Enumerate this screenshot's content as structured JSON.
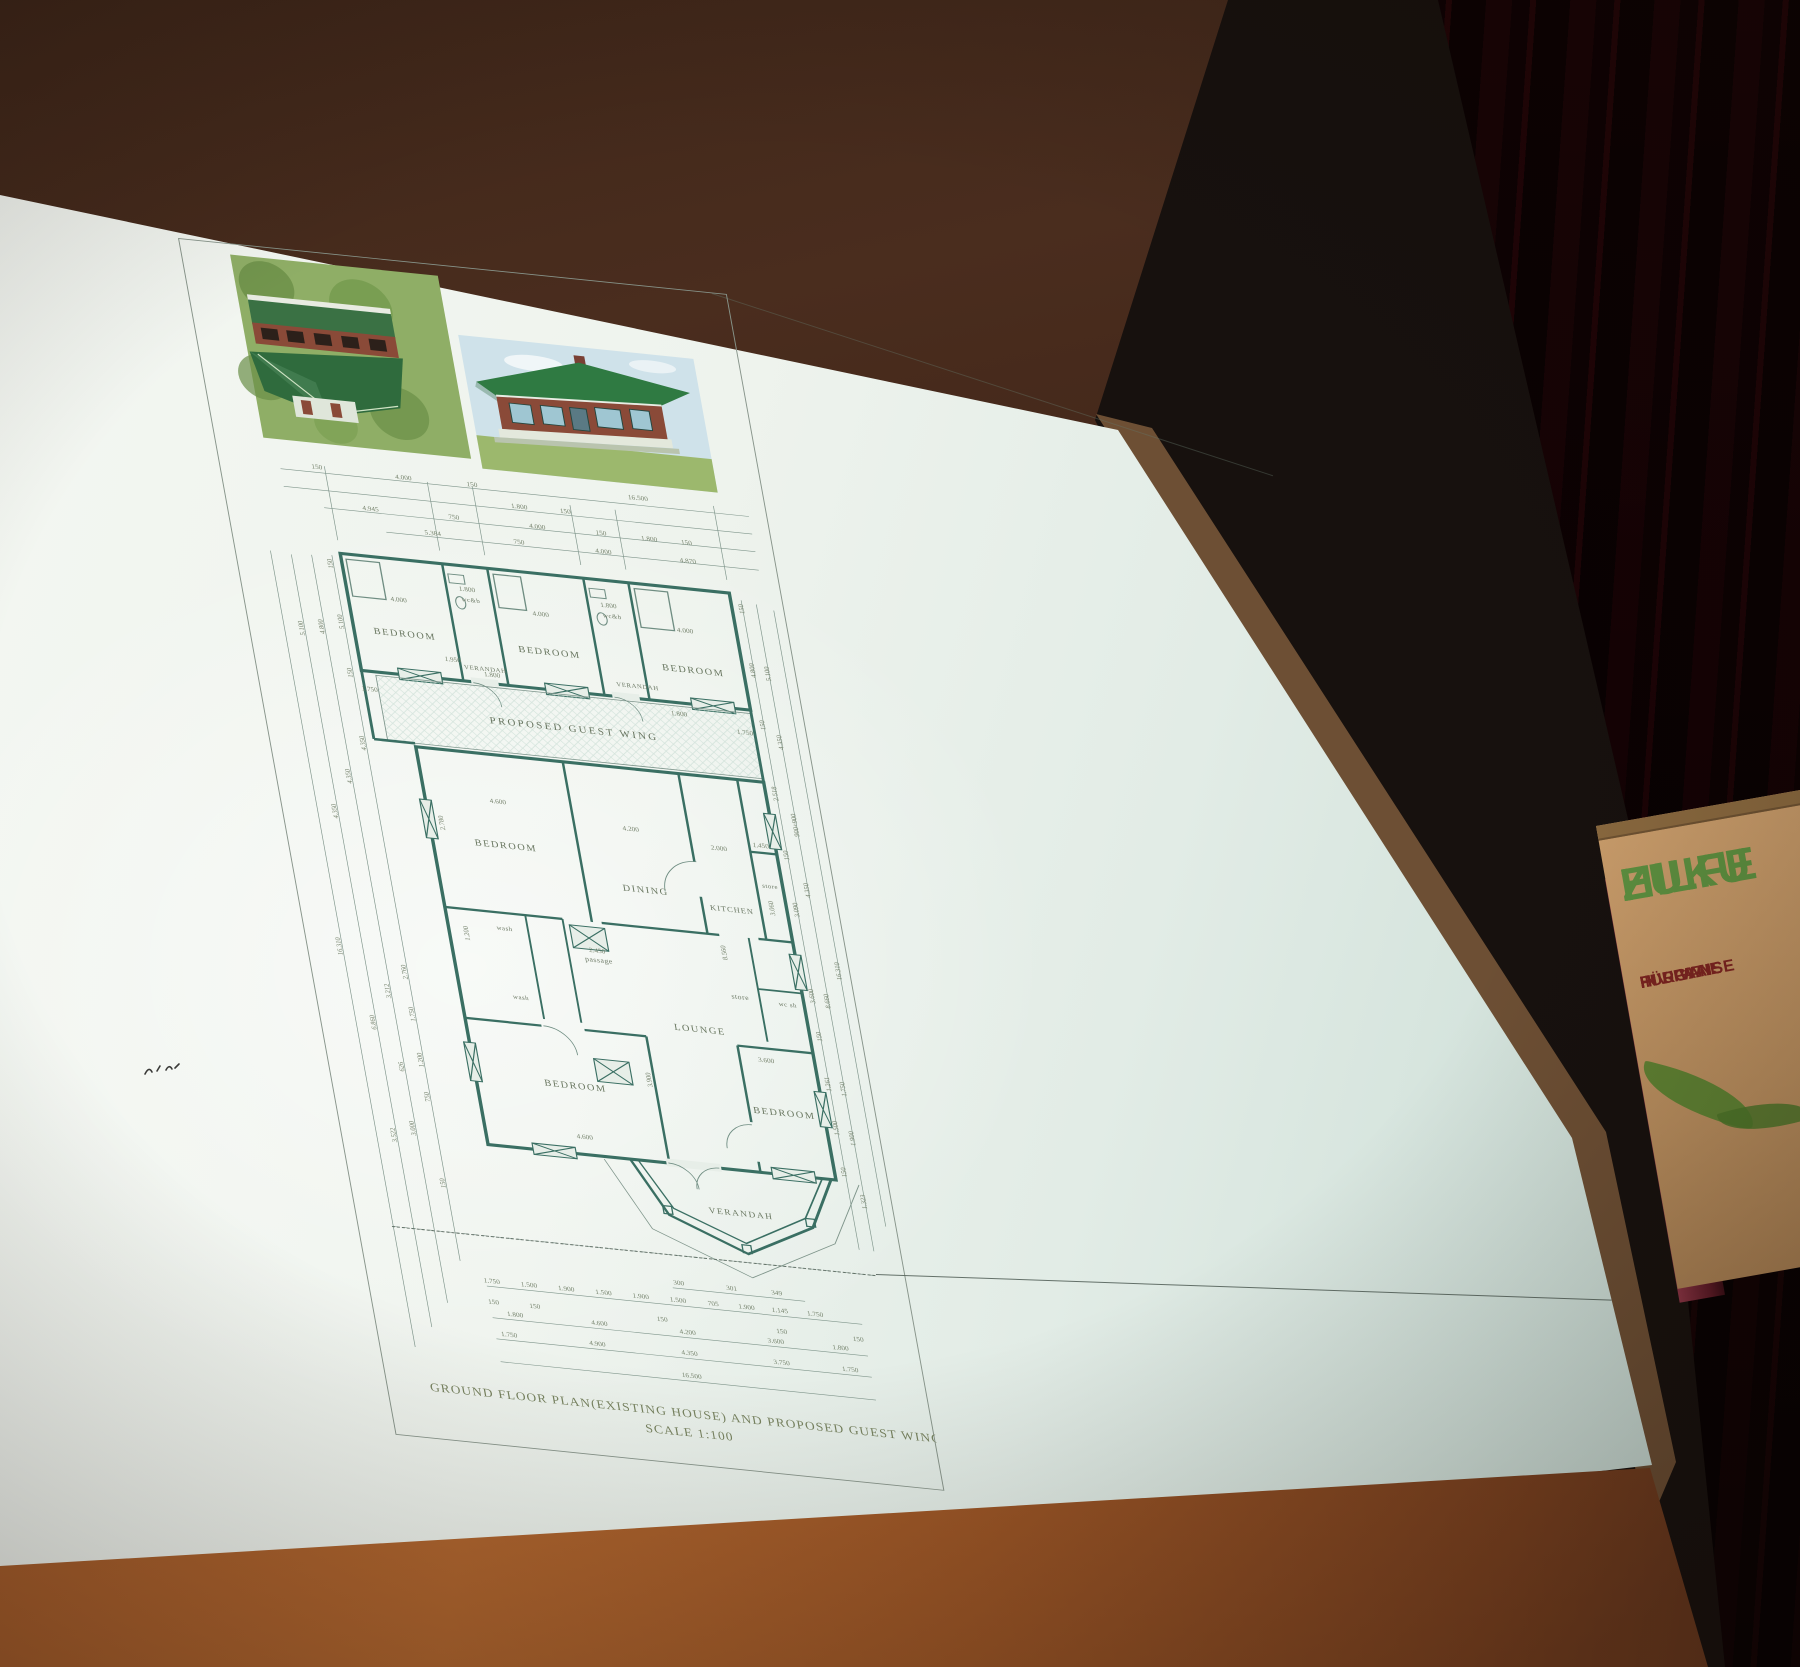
{
  "plan": {
    "title": "GROUND FLOOR PLAN(EXISTING HOUSE) AND PROPOSED GUEST WING",
    "scale": "SCALE 1:100",
    "wing_label": "PROPOSED GUEST WING",
    "rooms": [
      "BEDROOM",
      "wc&b",
      "BEDROOM",
      "wc&b",
      "BEDROOM",
      "VERANDAH",
      "VERANDAH",
      "BEDROOM",
      "DINING",
      "KITCHEN",
      "store",
      "passage",
      "wash",
      "wash",
      "store",
      "wc sh",
      "LOUNGE",
      "BEDROOM",
      "BEDROOM",
      "VERANDAH"
    ],
    "top_dims": [
      "150",
      "4.000",
      "150",
      "16.500",
      "1.800",
      "150",
      "4.945",
      "750",
      "4.000",
      "150",
      "1.800",
      "150",
      "5.384",
      "750",
      "4.000",
      "4.870"
    ],
    "inner_dims": [
      "4.000",
      "1.800",
      "4.000",
      "1.800",
      "4.000",
      "1.950",
      "1.800",
      "1.750",
      "1.800",
      "4.600",
      "2.780",
      "4.200",
      "2.000",
      "1.450",
      "3.060",
      "1.200",
      "2.450",
      "8.560",
      "3.900",
      "3.600",
      "4.600",
      "1.750"
    ],
    "left_dims": [
      "150",
      "5.100",
      "4.800",
      "5.100",
      "150",
      "4.350",
      "4.350",
      "4.350",
      "16.310",
      "2.760",
      "3.212",
      "6.860",
      "1.750",
      "1.200",
      "626",
      "750",
      "3.000",
      "3.522",
      "150"
    ],
    "right_dims": [
      "150",
      "4.800",
      "5.100",
      "150",
      "2.518",
      "900+900",
      "150",
      "16.310",
      "3.090",
      "3.600",
      "150",
      "4.350",
      "4.350",
      "1.261",
      "1.750",
      "1.500",
      "8.660",
      "1.900",
      "1.323",
      "150"
    ],
    "bottom_dims": {
      "offsets": [
        "300",
        "301",
        "349"
      ],
      "row1": [
        "1.750",
        "1.500",
        "1.900",
        "1.500",
        "1.900",
        "1.500",
        "705",
        "1.900",
        "1.145",
        "1.750"
      ],
      "row150": [
        "150",
        "150",
        "150",
        "150",
        "150"
      ],
      "row2": [
        "1.800",
        "4.600",
        "4.200",
        "3.600",
        "1.800"
      ],
      "row3": [
        "1.750",
        "4.900",
        "4.350",
        "3.750",
        "1.750"
      ],
      "total": "16.500"
    }
  },
  "banner": {
    "line1": "HILFE",
    "line2": "ZUKU",
    "sub1": "FÜR WAISE",
    "sub2": "HIV-PATIE",
    "sub3": "IN UGAN"
  },
  "colors": {
    "screen": "#edf2ec",
    "plan_line": "#3a6f63",
    "curtain": "#4f1b24",
    "table": "#a35a2a",
    "banner_bg": "#c19a68",
    "banner_green": "#5d9040",
    "banner_red": "#7b2420"
  }
}
